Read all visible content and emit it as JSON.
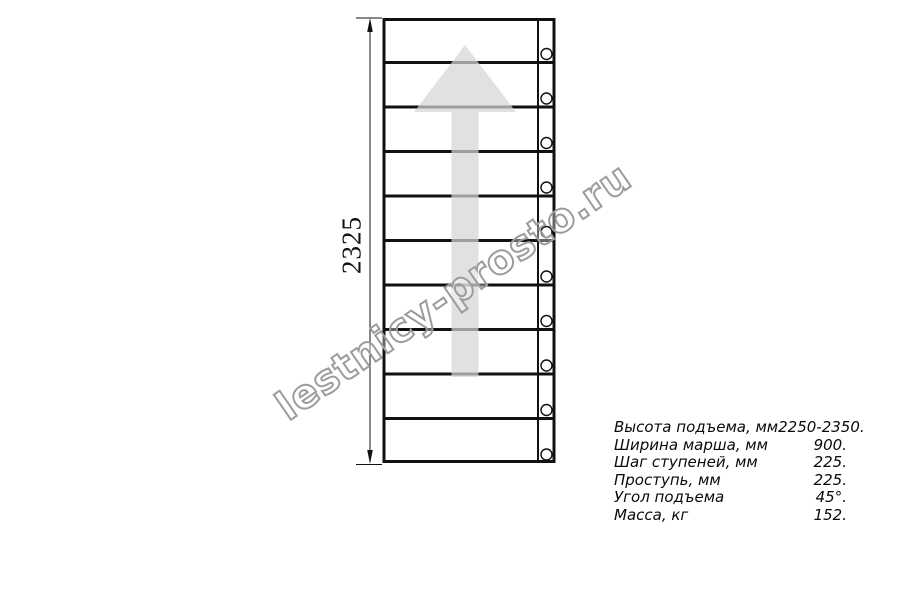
{
  "drawing": {
    "type": "staircase-plan-top-view",
    "dimension_label": "2325",
    "steps_count": 10,
    "arrow_direction": "up"
  },
  "watermark": {
    "text": "lestnicy-prosto.ru"
  },
  "specs": {
    "rows": [
      {
        "label": "Высота подъема, мм",
        "value": "2250-2350."
      },
      {
        "label": "Ширина марша, мм",
        "value": "900."
      },
      {
        "label": "Шаг ступеней, мм",
        "value": "225."
      },
      {
        "label": "Проступь, мм",
        "value": "225."
      },
      {
        "label": "Угол подъема",
        "value": "45°."
      },
      {
        "label": "Масса, кг",
        "value": "152."
      }
    ]
  },
  "colors": {
    "line": "#111111",
    "arrow_fill": "#d5d5d5",
    "watermark_stroke": "#9c9c9c"
  }
}
